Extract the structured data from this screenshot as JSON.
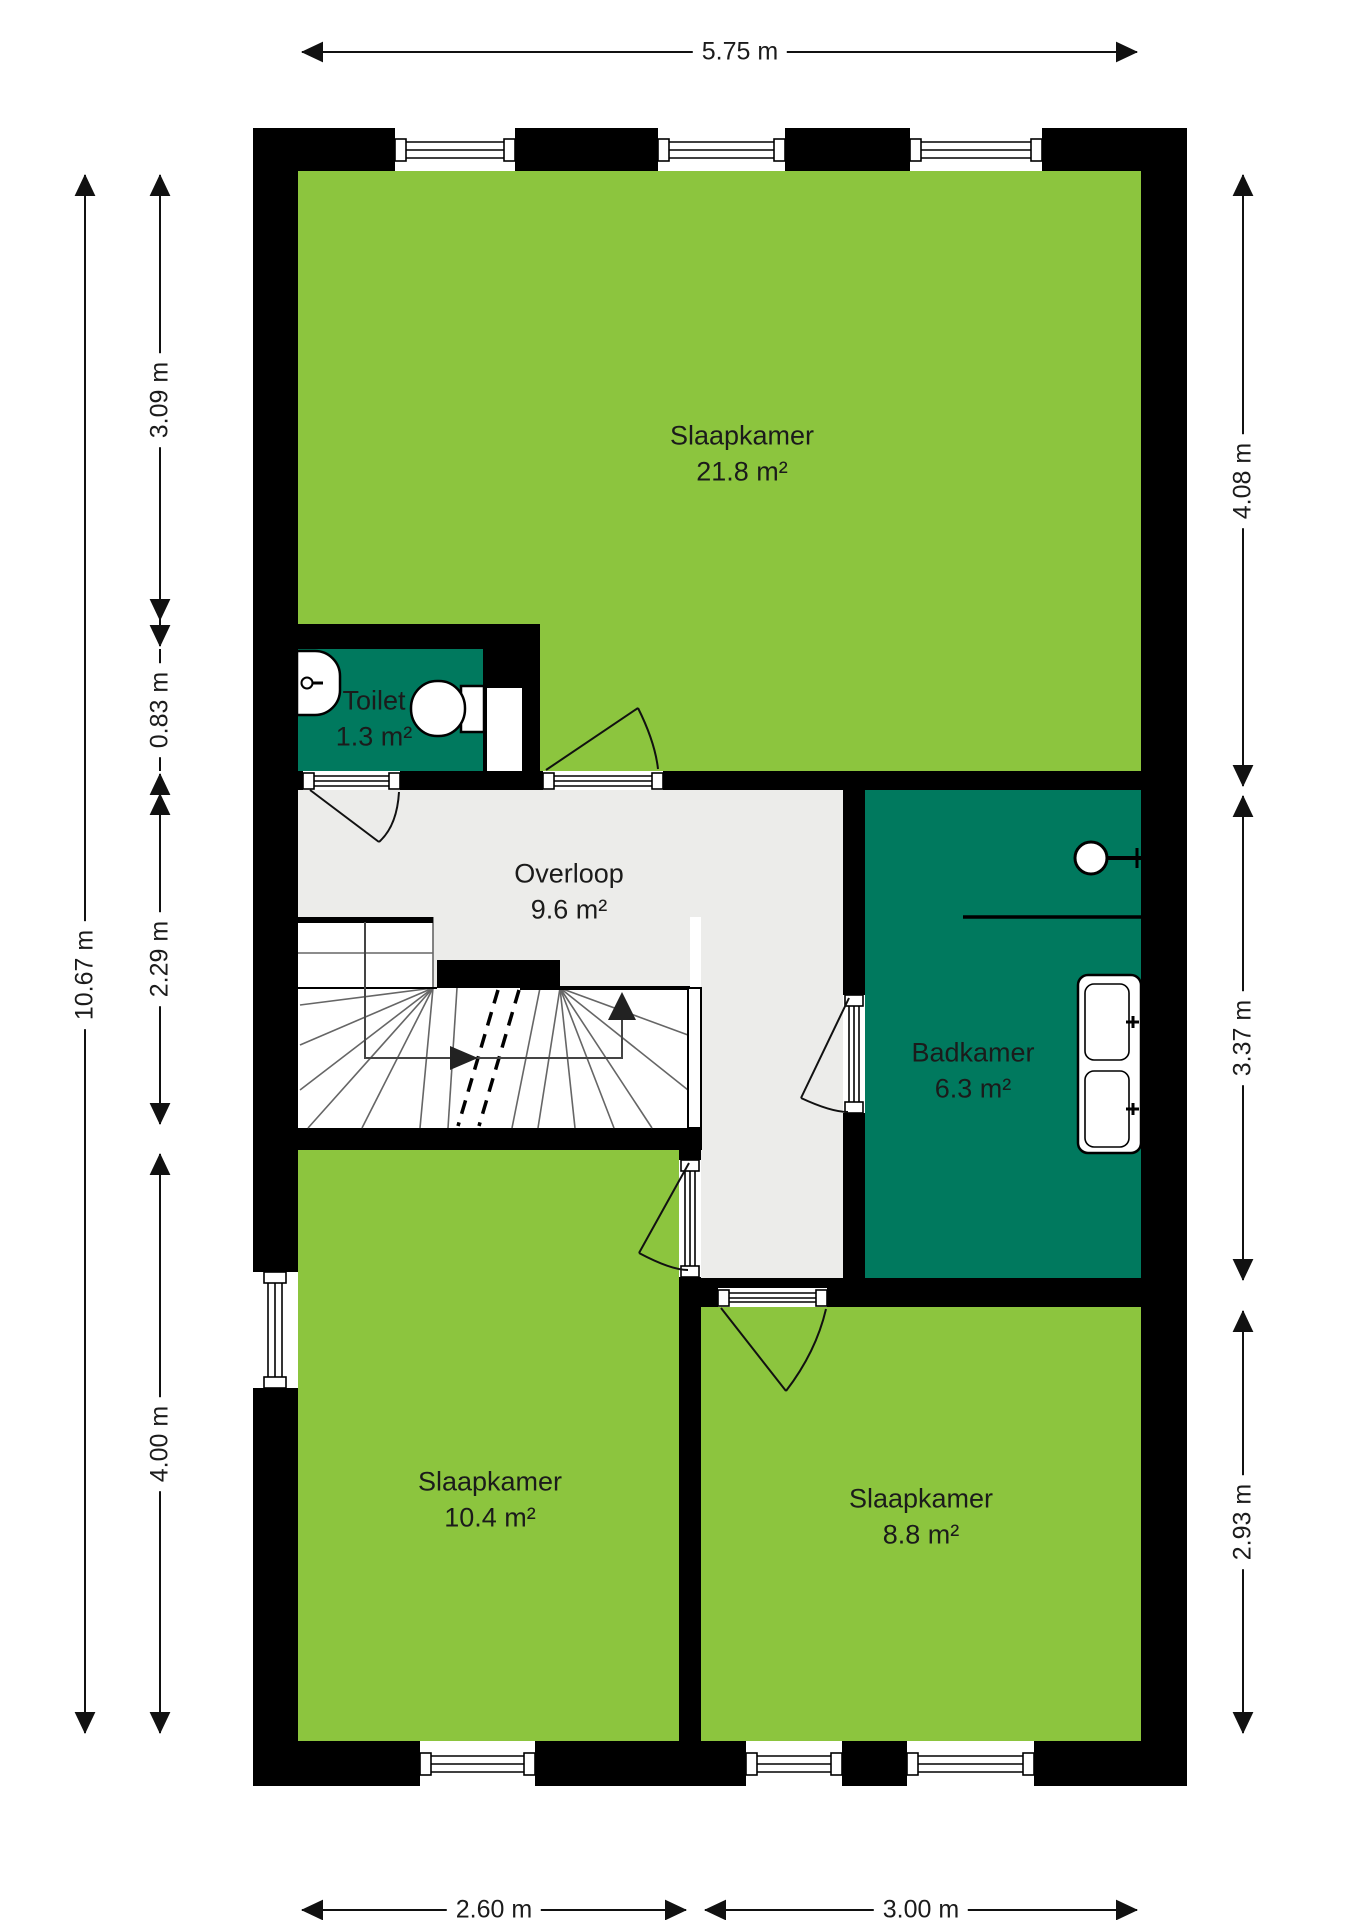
{
  "plan": {
    "rooms": [
      {
        "id": "slaapkamer-1",
        "name": "Slaapkamer",
        "area": "21.8 m²"
      },
      {
        "id": "toilet",
        "name": "Toilet",
        "area": "1.3 m²"
      },
      {
        "id": "overloop",
        "name": "Overloop",
        "area": "9.6 m²"
      },
      {
        "id": "badkamer",
        "name": "Badkamer",
        "area": "6.3 m²"
      },
      {
        "id": "slaapkamer-2",
        "name": "Slaapkamer",
        "area": "10.4 m²"
      },
      {
        "id": "slaapkamer-3",
        "name": "Slaapkamer",
        "area": "8.8 m²"
      }
    ],
    "dimensions": {
      "top": "5.75 m",
      "left_total": "10.67 m",
      "left_segments": [
        "3.09 m",
        "0.83 m",
        "2.29 m",
        "4.00 m"
      ],
      "right_segments": [
        "4.08 m",
        "3.37 m",
        "2.93 m"
      ],
      "bottom_segments": [
        "2.60 m",
        "3.00 m"
      ]
    },
    "colors": {
      "room_green": "#8CC53E",
      "wet_room_teal": "#00795E",
      "landing_gray": "#ECECEA",
      "wall_black": "#000000"
    }
  }
}
